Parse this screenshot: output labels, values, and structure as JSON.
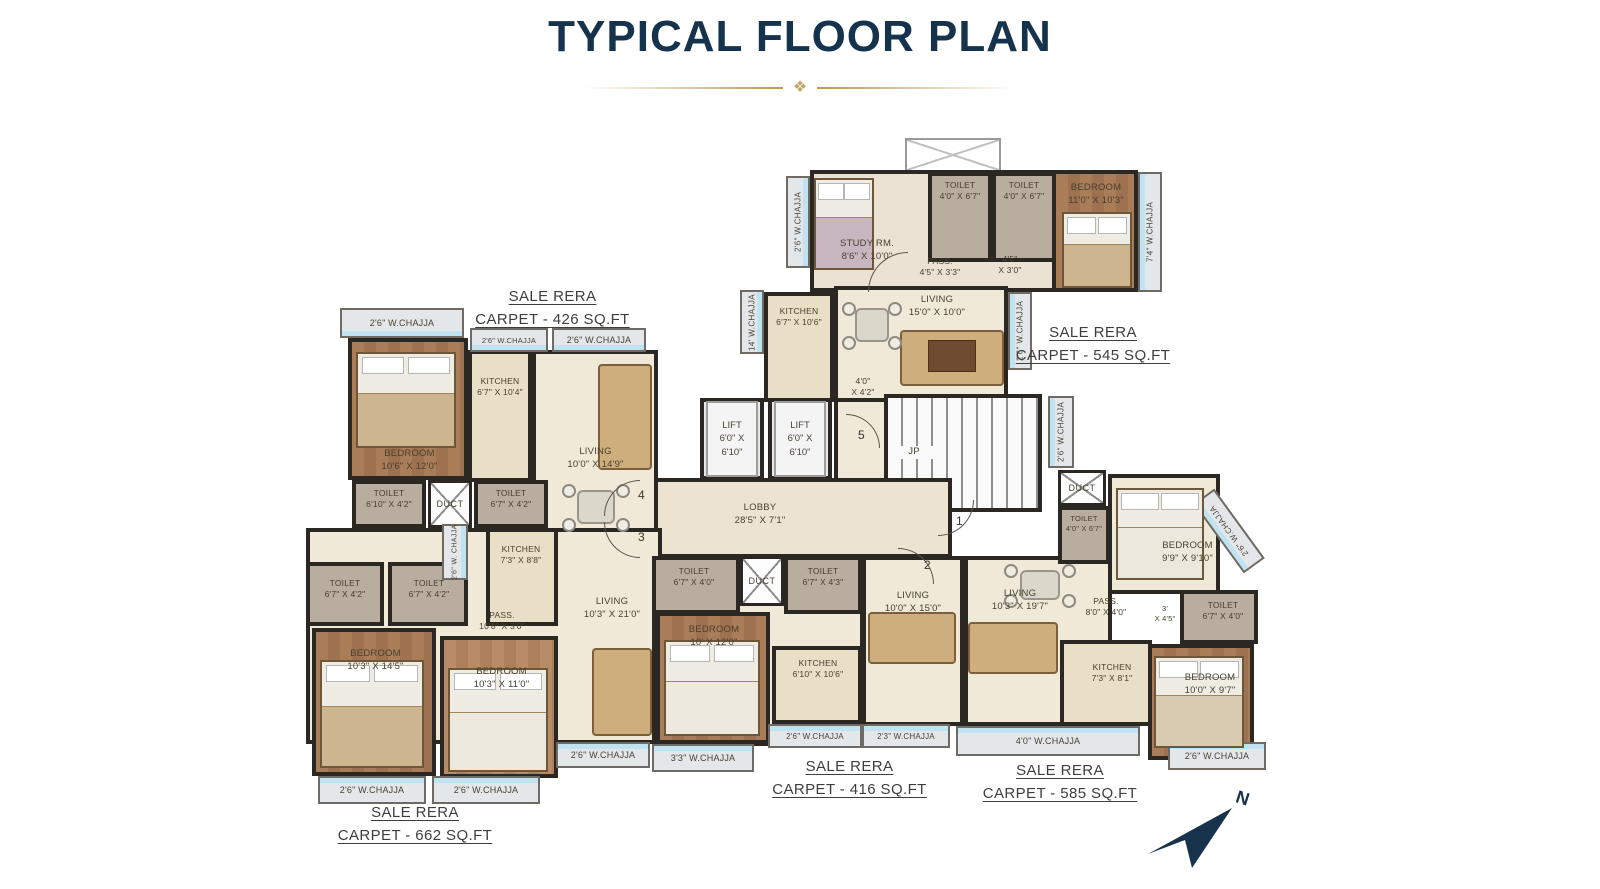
{
  "title": "TYPICAL FLOOR PLAN",
  "ornament": "❖",
  "rera": {
    "u426": {
      "l1": "SALE RERA",
      "l2": "CARPET - 426 SQ.FT"
    },
    "u545": {
      "l1": "SALE RERA",
      "l2": "CARPET - 545 SQ.FT"
    },
    "u662": {
      "l1": "SALE RERA",
      "l2": "CARPET - 662 SQ.FT"
    },
    "u416": {
      "l1": "SALE RERA",
      "l2": "CARPET - 416 SQ.FT"
    },
    "u585": {
      "l1": "SALE RERA",
      "l2": "CARPET - 585 SQ.FT"
    }
  },
  "rooms": {
    "study": {
      "nm": "STUDY RM.",
      "dim": "8'6\" X 10'0\""
    },
    "toilet_t1": {
      "nm": "TOILET",
      "dim": "4'0\" X 6'7\""
    },
    "toilet_t2": {
      "nm": "TOILET",
      "dim": "4'0\" X 6'7\""
    },
    "pass_top": {
      "nm": "PASS.",
      "dim": "4'5\" X 3'3\""
    },
    "niche_top": {
      "nm": "4'5\"",
      "dim": "X 3'0\""
    },
    "bed_top": {
      "nm": "BEDROOM",
      "dim": "11'0\" X 10'3\""
    },
    "kitchen_545": {
      "nm": "KITCHEN",
      "dim": "6'7\" X 10'6\""
    },
    "living_545": {
      "nm": "LIVING",
      "dim": "15'0\" X 10'0\""
    },
    "pass_core": {
      "nm": "4'0\"",
      "dim": "X 4'2\""
    },
    "bed_426": {
      "nm": "BEDROOM",
      "dim": "10'6\" X 12'0\""
    },
    "kitchen_426": {
      "nm": "KITCHEN",
      "dim": "6'7\" X 10'4\""
    },
    "living_426": {
      "nm": "LIVING",
      "dim": "10'0\" X 14'9\""
    },
    "toilet_426a": {
      "nm": "TOILET",
      "dim": "6'10\" X 4'2\""
    },
    "toilet_426b": {
      "nm": "TOILET",
      "dim": "6'7\" X 4'2\""
    },
    "kitchen_662": {
      "nm": "KITCHEN",
      "dim": "7'3\" X 8'8\""
    },
    "toilet_662a": {
      "nm": "TOILET",
      "dim": "6'7\" X 4'2\""
    },
    "toilet_662b": {
      "nm": "TOILET",
      "dim": "6'7\" X 4'2\""
    },
    "pass_662": {
      "nm": "PASS.",
      "dim": "10'8\" X 3'0\""
    },
    "bed_662a": {
      "nm": "BEDROOM",
      "dim": "10'3\" X 14'5\""
    },
    "bed_662b": {
      "nm": "BEDROOM",
      "dim": "10'3\" X 11'0\""
    },
    "living_662": {
      "nm": "LIVING",
      "dim": "10'3\" X 21'0\""
    },
    "toilet_416a": {
      "nm": "TOILET",
      "dim": "6'7\" X 4'0\""
    },
    "toilet_416b": {
      "nm": "TOILET",
      "dim": "6'7\" X 4'3\""
    },
    "bed_416": {
      "nm": "BEDROOM",
      "dim": "10' X 12'0\""
    },
    "kitchen_416": {
      "nm": "KITCHEN",
      "dim": "6'10\" X 10'6\""
    },
    "living_416": {
      "nm": "LIVING",
      "dim": "10'0\" X 15'0\""
    },
    "living_585": {
      "nm": "LIVING",
      "dim": "10'3\" X 19'7\""
    },
    "pass_585": {
      "nm": "PASS.",
      "dim": "8'0\" X 4'0\""
    },
    "kitchen_585": {
      "nm": "KITCHEN",
      "dim": "7'3\" X 8'1\""
    },
    "bed_585a": {
      "nm": "BEDROOM",
      "dim": "9'9\" X 9'10\""
    },
    "toilet_585a": {
      "nm": "TOILET",
      "dim": "4'0\" X 6'7\""
    },
    "pass_585s": {
      "nm": "3'",
      "dim": "X 4'5\""
    },
    "toilet_585b": {
      "nm": "TOILET",
      "dim": "6'7\" X 4'0\""
    },
    "bed_585b": {
      "nm": "BEDROOM",
      "dim": "10'0\" X 9'7\""
    }
  },
  "core": {
    "lift_nm": "LIFT",
    "lift_dim": "6'0\" X 6'10\"",
    "lobby_nm": "LOBBY",
    "lobby_dim": "28'5\" X 7'1\"",
    "jp": "JP",
    "duct": "DUCT"
  },
  "chajja": {
    "c426_top": "2'6\" W.CHAJJA",
    "c426_kitchen": "2'6\" W.CHAJJA",
    "c426_living": "2'6\" W.CHAJJA",
    "c545_left": "2'6\" W.CHAJJA",
    "c545_right": "7'4\" W.CHAJJA",
    "c545_kitchen": "14' W.CHAJJA",
    "c545_mid": "2'6\" W.CHAJJA",
    "c545_low": "2'6\" W.CHAJJA",
    "c662_vert": "2'6\" W. CHAJJA",
    "c662_b1": "2'6\" W.CHAJJA",
    "c662_b2": "2'6\" W.CHAJJA",
    "c662_mid": "2'6\" W.CHAJJA",
    "c416_33": "3'3\" W.CHAJJA",
    "c416_26": "2'6\" W.CHAJJA",
    "c416_23": "2'3\" W.CHAJJA",
    "c585_40": "4'0\" W.CHAJJA",
    "c585_b": "2'6\" W.CHAJJA",
    "c585_diag": "2'6\" W.CHAJJA"
  },
  "numbers": {
    "n1": "1",
    "n2": "2",
    "n3": "3",
    "n4": "4",
    "n5": "5"
  },
  "compass": {
    "n": "N"
  }
}
